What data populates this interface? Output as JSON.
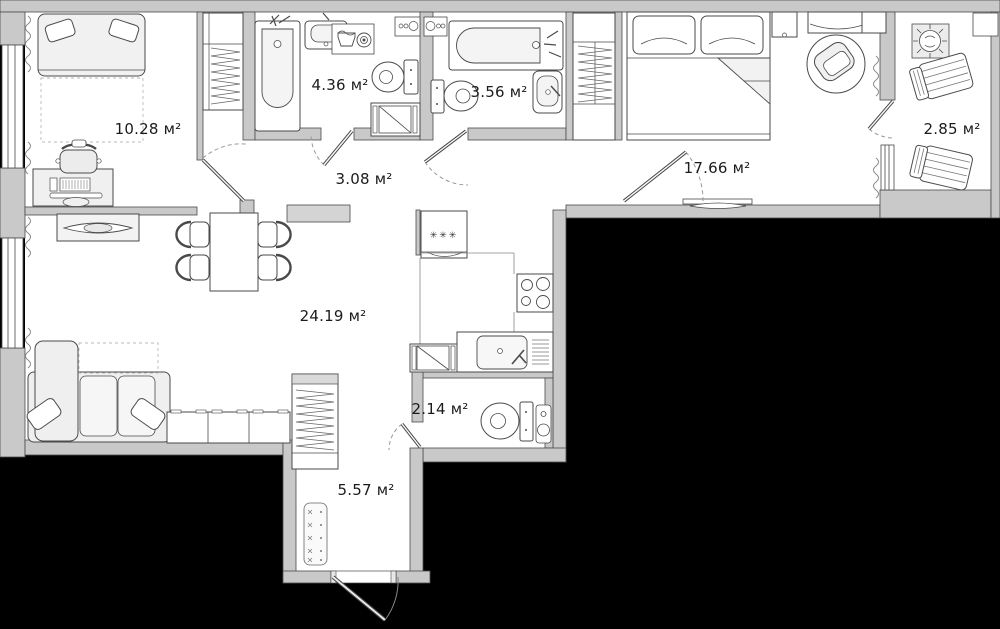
{
  "page": {
    "type": "apartment-floor-plan"
  },
  "rooms": [
    {
      "id": "small-bedroom",
      "area_label": "10.28 м²"
    },
    {
      "id": "bathroom-large",
      "area_label": "4.36 м²"
    },
    {
      "id": "bathroom-small",
      "area_label": "3.56 м²"
    },
    {
      "id": "corridor",
      "area_label": "3.08 м²"
    },
    {
      "id": "master-bedroom",
      "area_label": "17.66 м²"
    },
    {
      "id": "balcony",
      "area_label": "2.85 м²"
    },
    {
      "id": "living-kitchen",
      "area_label": "24.19 м²"
    },
    {
      "id": "wc",
      "area_label": "2.14 м²"
    },
    {
      "id": "hallway",
      "area_label": "5.57 м²"
    }
  ],
  "icons": {
    "freezer_symbol": "✳✳✳"
  },
  "colors": {
    "background": "#000000",
    "wall": "#c9c9c9",
    "floor": "#ffffff",
    "outline": "#4a4a4a",
    "furniture_fill": "#f0f0f0"
  }
}
